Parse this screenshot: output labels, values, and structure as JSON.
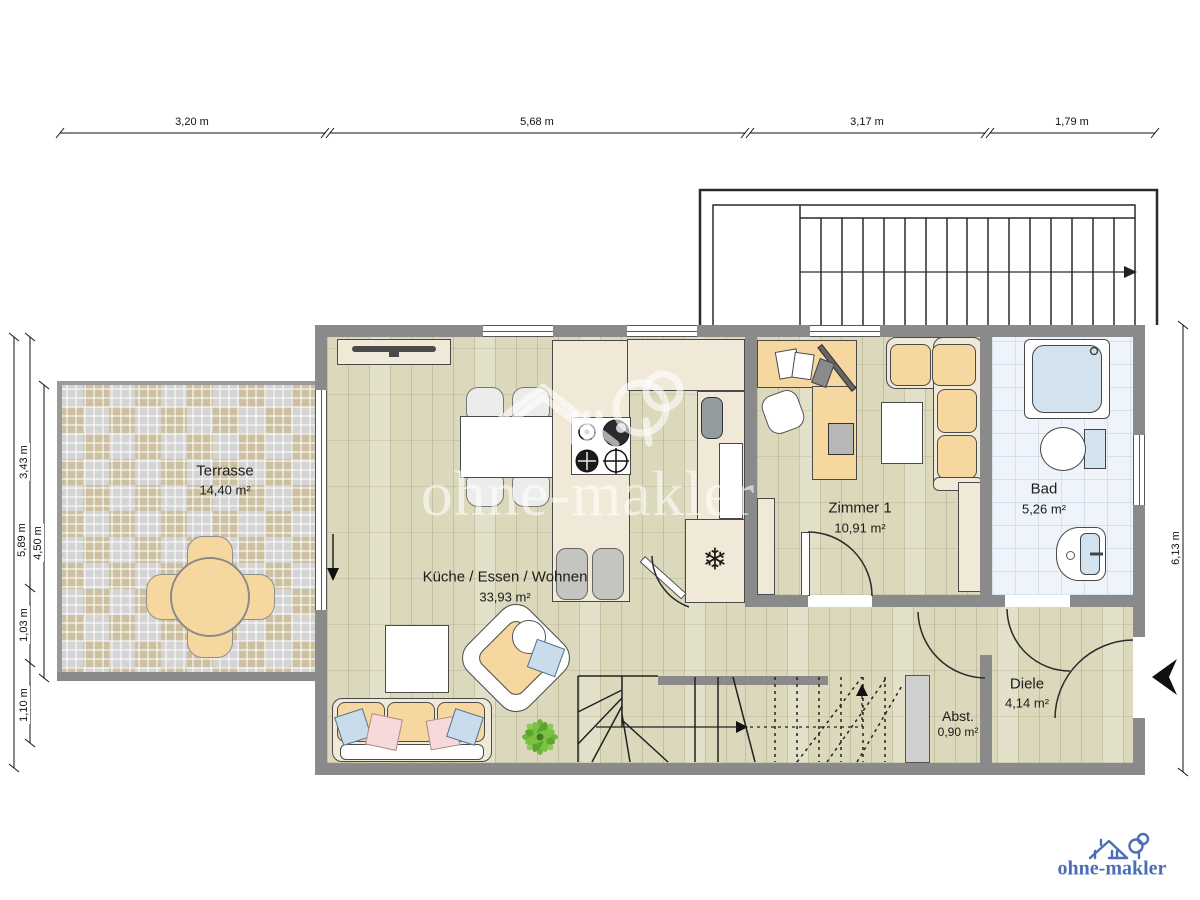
{
  "dimensions": {
    "top": [
      "3,20 m",
      "5,68 m",
      "3,17 m",
      "1,79 m"
    ],
    "left": {
      "total": "5,89 m",
      "segments": [
        "3,43 m",
        "1,03 m",
        "1,10 m"
      ],
      "terrace": "4,50 m"
    },
    "right": "6,13 m"
  },
  "rooms": [
    {
      "name": "Terrasse",
      "area": "14,40 m²"
    },
    {
      "name": "Küche / Essen / Wohnen",
      "area": "33,93 m²"
    },
    {
      "name": "Zimmer 1",
      "area": "10,91 m²"
    },
    {
      "name": "Bad",
      "area": "5,26 m²"
    },
    {
      "name": "Diele",
      "area": "4,14 m²"
    },
    {
      "name": "Abst.",
      "area": "0,90 m²"
    }
  ],
  "symbols": {
    "freezer": "❄"
  },
  "watermark": {
    "text": "ohne-makler"
  },
  "logo": {
    "text": "ohne-makler",
    "color": "#4a6fb7"
  },
  "colors": {
    "wall": "#8a8a8a",
    "wood": "#dbd8bc",
    "accent_orange": "#f7d7a0",
    "bath_floor": "#eef4f9",
    "logo_blue": "#4a6fb7"
  }
}
